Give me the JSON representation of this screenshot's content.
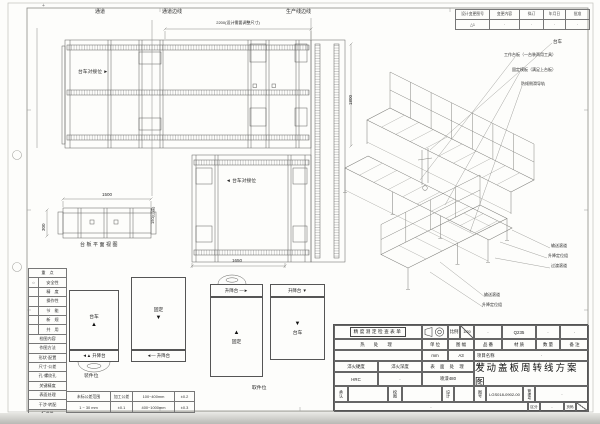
{
  "frame": {
    "corner_mark": "+"
  },
  "revision_table": {
    "headers": [
      "设计变更图号",
      "变更内容",
      "拟订",
      "年月日",
      "批准"
    ],
    "row": [
      "△1",
      "·",
      "·",
      "·",
      "·"
    ]
  },
  "plan_view": {
    "label_aisle": "通道",
    "label_aisle_edge": "通道边线",
    "label_line_edge": "生产线边线",
    "dim_2200": "2200(设计需要调整尺寸)",
    "dim_1800": "1800",
    "dim_1650": "1650",
    "dock_label_top": "台车对接位",
    "dock_arrow_top": "►",
    "dock_label_bottom": "台车对接位",
    "dock_arrow_bottom": "◄"
  },
  "side_view": {
    "dim_1500": "1500",
    "dim_300": "300",
    "dim_150": "150(过渡)",
    "caption": "台板平面视图"
  },
  "iso_view": {
    "callout_cart": "台车",
    "callout_worktable": "工作台板（一台装两用工具）",
    "callout_fixed_plate": "固定模板（满足上台板）",
    "callout_guide_rail": "防倾侧滑导轨",
    "callout_roller_1": "输送滚道",
    "callout_lift_1": "升降定位组",
    "callout_transition": "过渡滚道",
    "callout_roller_2": "输送滚道",
    "callout_lift_2": "升降定位组"
  },
  "legend": {
    "header_focus": "重　点",
    "focus_rows": [
      {
        "mark": "○",
        "label": "安全性"
      },
      {
        "mark": "",
        "label": "精　度"
      },
      {
        "mark": "",
        "label": "操作性"
      },
      {
        "mark": "",
        "label": "节　能"
      },
      {
        "mark": "",
        "label": "新　规"
      },
      {
        "mark": "",
        "label": "共　用"
      }
    ],
    "header_check": "检图内容",
    "check_rows": [
      "作图方法",
      "形状·配置",
      "尺寸·公差",
      "孔·螺纹孔",
      "关键精度",
      "表面处理",
      "干涉·转配",
      "标准件"
    ]
  },
  "tolerance_table": {
    "rows": [
      [
        "未标公差范围",
        "加工公差",
        "100~400mm",
        "±0.2"
      ],
      [
        "1 ~ 30 mm",
        "±0.1",
        "400~1000mm",
        "±0.3"
      ],
      [
        "30 ~ 100 mm",
        "±0.15",
        "1000~2000mm",
        "±0.5"
      ]
    ]
  },
  "schematics": {
    "group_a": {
      "box1_label": "台车",
      "box1_arrow": "▲",
      "box1_strip": "◄▲ 升降台",
      "box2_label": "固定",
      "box2_arrow": "▼",
      "box2_strip": "◄— 升降台",
      "caption": "装件位"
    },
    "group_b": {
      "box1_strip": "升降台 —►",
      "box1_arrow": "▲",
      "box1_label": "固定",
      "box2_strip": "升降台 ▼",
      "box2_arrow": "▼",
      "box2_label": "台车",
      "caption": "取件位"
    }
  },
  "title_block": {
    "checklist": "精度测定检查表单",
    "scale_label": "比例",
    "scale_value": "1/20",
    "heat_label": "热 处 理",
    "unit_label": "单 位",
    "unit_value": "mm",
    "sheet_label": "图 幅",
    "sheet_value": "A3",
    "part_label": "品 番",
    "part_value": "·",
    "material_label": "材 质",
    "material_value": "Q235",
    "qty_label": "数 量",
    "qty_value": "·",
    "remark_label": "备 注",
    "remark_value": "·",
    "project_label": "项目名称",
    "project_value": "·",
    "hardness_label": "淬火硬度",
    "hardness_value": "HRC",
    "depth_label": "淬火深度",
    "depth_value": "·",
    "surface_label": "表 面 处 理",
    "surface_value": "喷漆480",
    "name_label": "名称",
    "name_value": "发动盖板周转线方案图",
    "approve_label": "承认",
    "check_label": "校图",
    "design_label": "设计",
    "dwg_label": "图号",
    "dwg_value": "LGS018-0902-00",
    "mgmt_label": "管理号",
    "mgmt_value": "·",
    "note_value": "·",
    "class_label": "区分",
    "class_value": "·",
    "page_label": "页码"
  }
}
